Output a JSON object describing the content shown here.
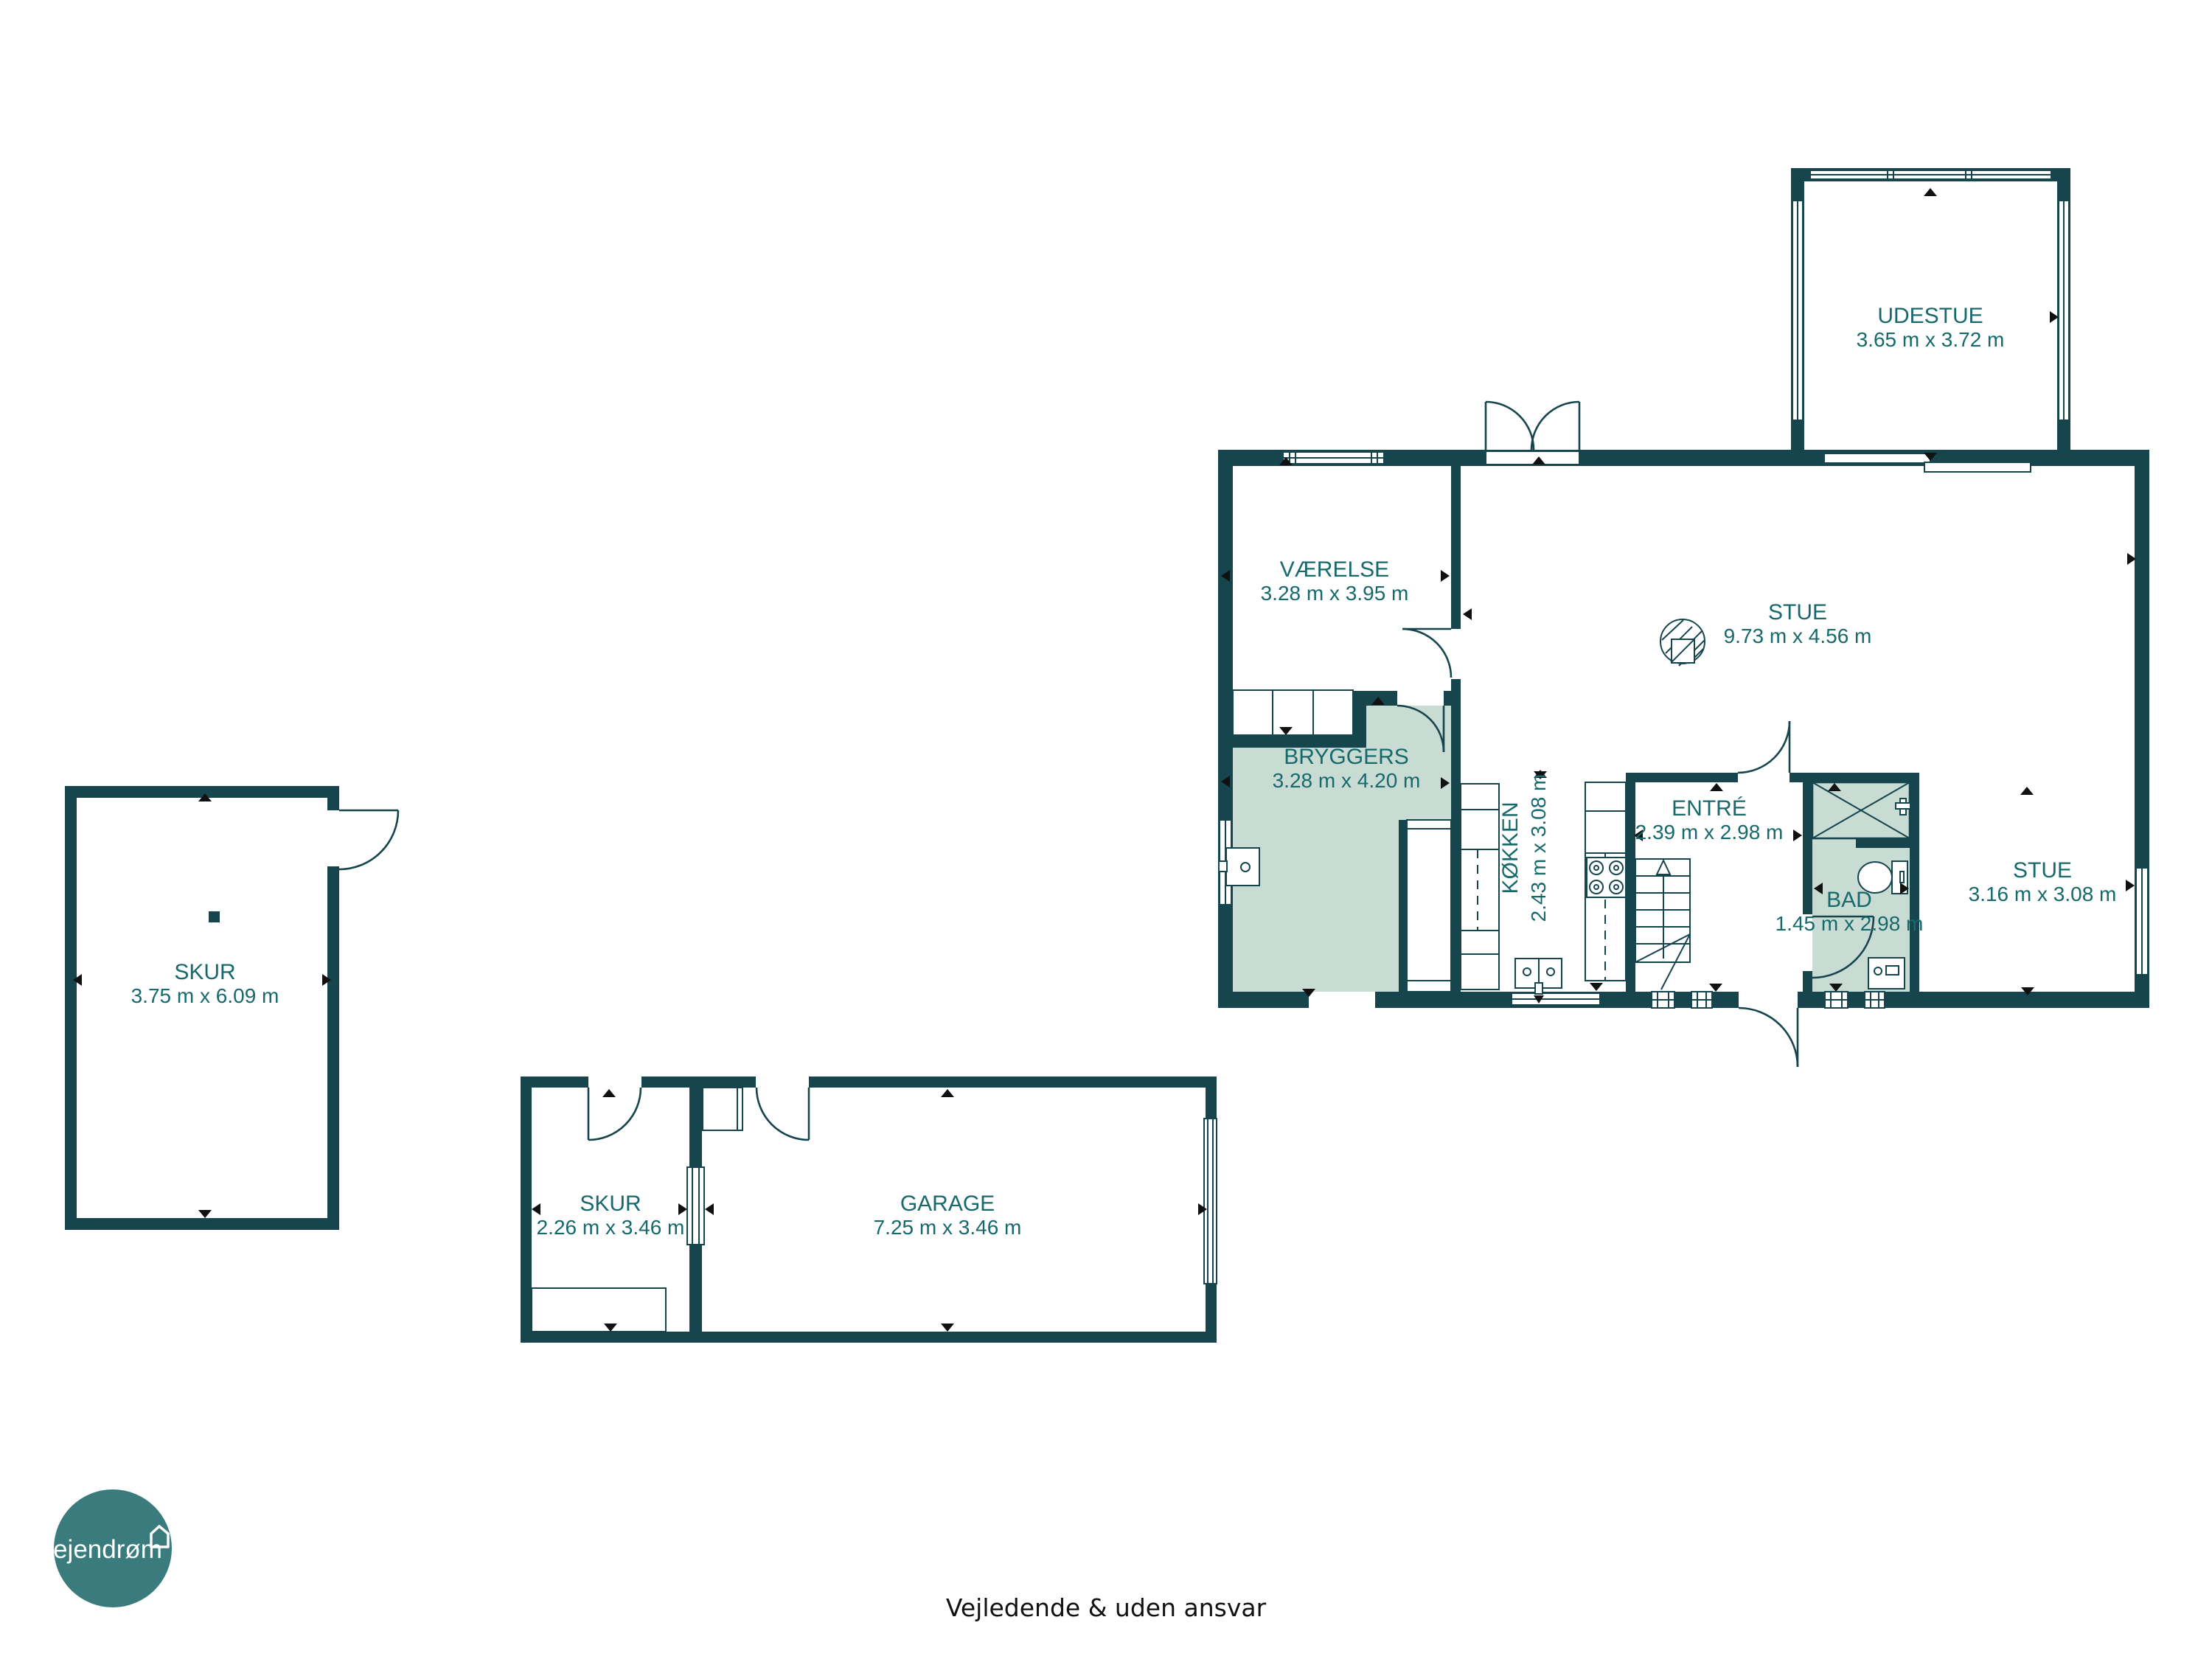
{
  "colors": {
    "wall": "#17454e",
    "highlight": "#c9dcd4",
    "label": "#17696c",
    "logo": "#3a7b7d",
    "marker": "#111111",
    "text": "#111111"
  },
  "rooms": [
    {
      "id": "udestue",
      "name": "UDESTUE",
      "dims": "3.65 m x 3.72 m"
    },
    {
      "id": "vaerelse",
      "name": "VÆRELSE",
      "dims": "3.28 m x 3.95 m"
    },
    {
      "id": "stue",
      "name": "STUE",
      "dims": "9.73 m x 4.56 m"
    },
    {
      "id": "bryggers",
      "name": "BRYGGERS",
      "dims": "3.28 m x 4.20 m"
    },
    {
      "id": "koekken",
      "name": "KØKKEN",
      "dims": "2.43 m x 3.08 m"
    },
    {
      "id": "entre",
      "name": "ENTRÉ",
      "dims": "2.39 m x 2.98 m"
    },
    {
      "id": "bad",
      "name": "BAD",
      "dims": "1.45 m x 2.98 m"
    },
    {
      "id": "stue2",
      "name": "STUE",
      "dims": "3.16 m x 3.08 m"
    },
    {
      "id": "skur1",
      "name": "SKUR",
      "dims": "3.75 m x 6.09 m"
    },
    {
      "id": "skur2",
      "name": "SKUR",
      "dims": "2.26 m x 3.46 m"
    },
    {
      "id": "garage",
      "name": "GARAGE",
      "dims": "7.25 m x 3.46 m"
    }
  ],
  "icons": {
    "fireplace": "hatched-circle-with-square",
    "stairs": "treads-with-up-arrow-and-cut-line",
    "shower": "crossed-box",
    "toilet": "bowl-with-cistern",
    "stove": "four-burner-rings",
    "sink": "basin-with-drain",
    "door": "quarter-arc-swing",
    "window": "double-line-band"
  },
  "branding": {
    "logo_text": "ejendrøm"
  },
  "footer": {
    "disclaimer": "Vejledende & uden ansvar"
  }
}
